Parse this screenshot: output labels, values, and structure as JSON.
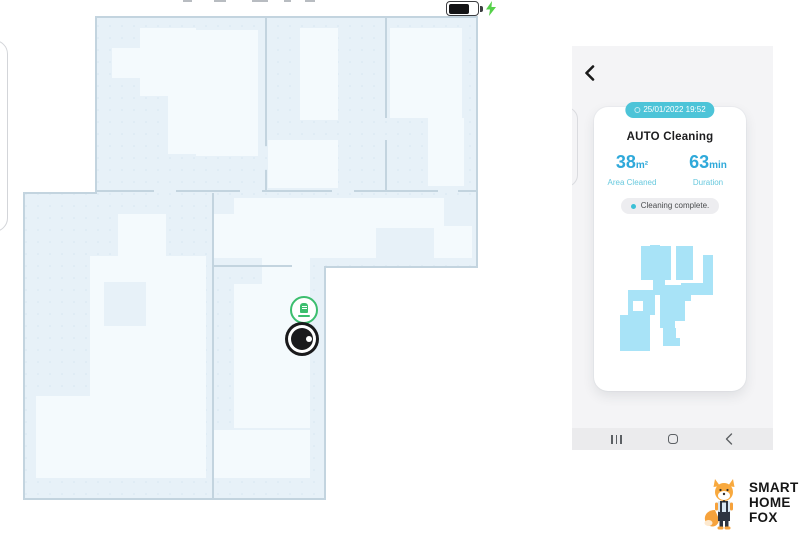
{
  "status_bar": {
    "battery_icon": "battery",
    "charging_bolt_icon": "lightning-bolt",
    "battery_fill_percent": 70
  },
  "map": {
    "dock_icon": "charging-dock",
    "robot_icon": "robot-vacuum",
    "colors": {
      "room_fill": "#e7f1f8",
      "room_light_patch": "#f4fafd",
      "wall": "#c3d4df",
      "dock_green": "#3cbe6e",
      "robot_black": "#1a1a1c"
    }
  },
  "phone": {
    "back_icon": "back-chevron",
    "session_card": {
      "timestamp": "25/01/2022 19:52",
      "title": "AUTO Cleaning",
      "stats": [
        {
          "value": "38",
          "unit": "m²",
          "label": "Area Cleaned"
        },
        {
          "value": "63",
          "unit": "min",
          "label": "Duration"
        }
      ],
      "status": "Cleaning complete.",
      "mini_map_icon": "cleaned-area-blob",
      "accent_teal": "#4dc4d8",
      "stat_blue": "#2fa9da",
      "blob_color": "#a8e3f7"
    },
    "nav": {
      "recents_icon": "recents-bars",
      "home_icon": "home-outline",
      "back_icon": "back-chevron"
    }
  },
  "logo": {
    "mascot_icon": "fox-mascot",
    "lines": [
      "SMART",
      "HOME",
      "FOX"
    ]
  }
}
